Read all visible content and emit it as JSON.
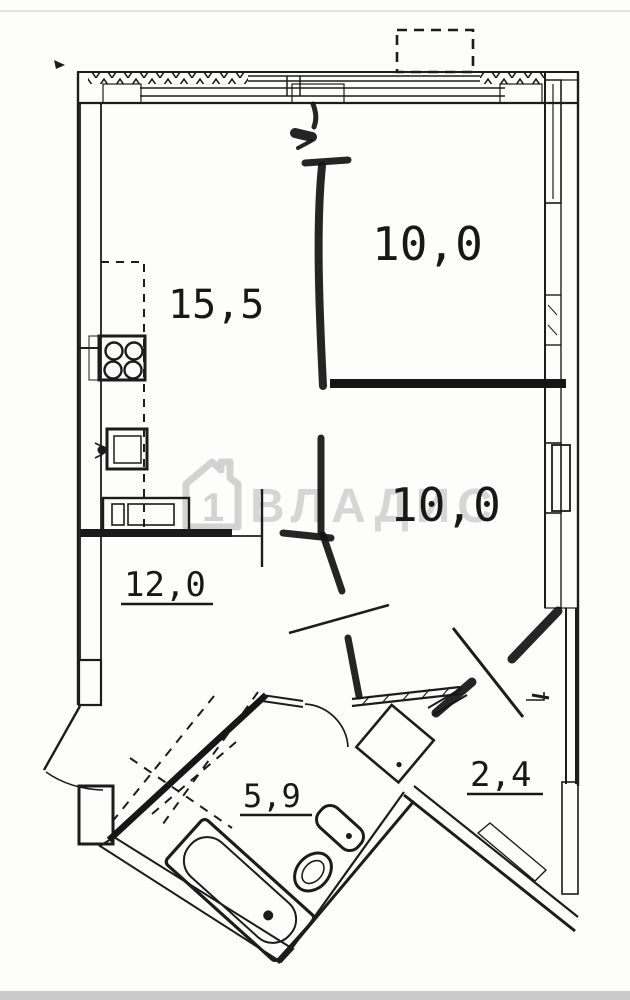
{
  "document": {
    "type": "apartment-floor-plan"
  },
  "watermark": {
    "brand": "ВЛАДИС",
    "house_number": "1"
  },
  "rooms": {
    "kitchen_living": {
      "label": "15,5"
    },
    "bedroom_top": {
      "label": "10,0"
    },
    "bedroom_middle": {
      "label": "10,0"
    },
    "hallway": {
      "label": "12,0"
    },
    "bathroom": {
      "label": "5,9"
    },
    "storage": {
      "label": "2,4"
    }
  },
  "colors": {
    "ink": "#1c1c1c",
    "watermark_gray": "#d6d6d6",
    "paper": "#fdfdfc",
    "bottom_band": "#c9c9c9"
  }
}
